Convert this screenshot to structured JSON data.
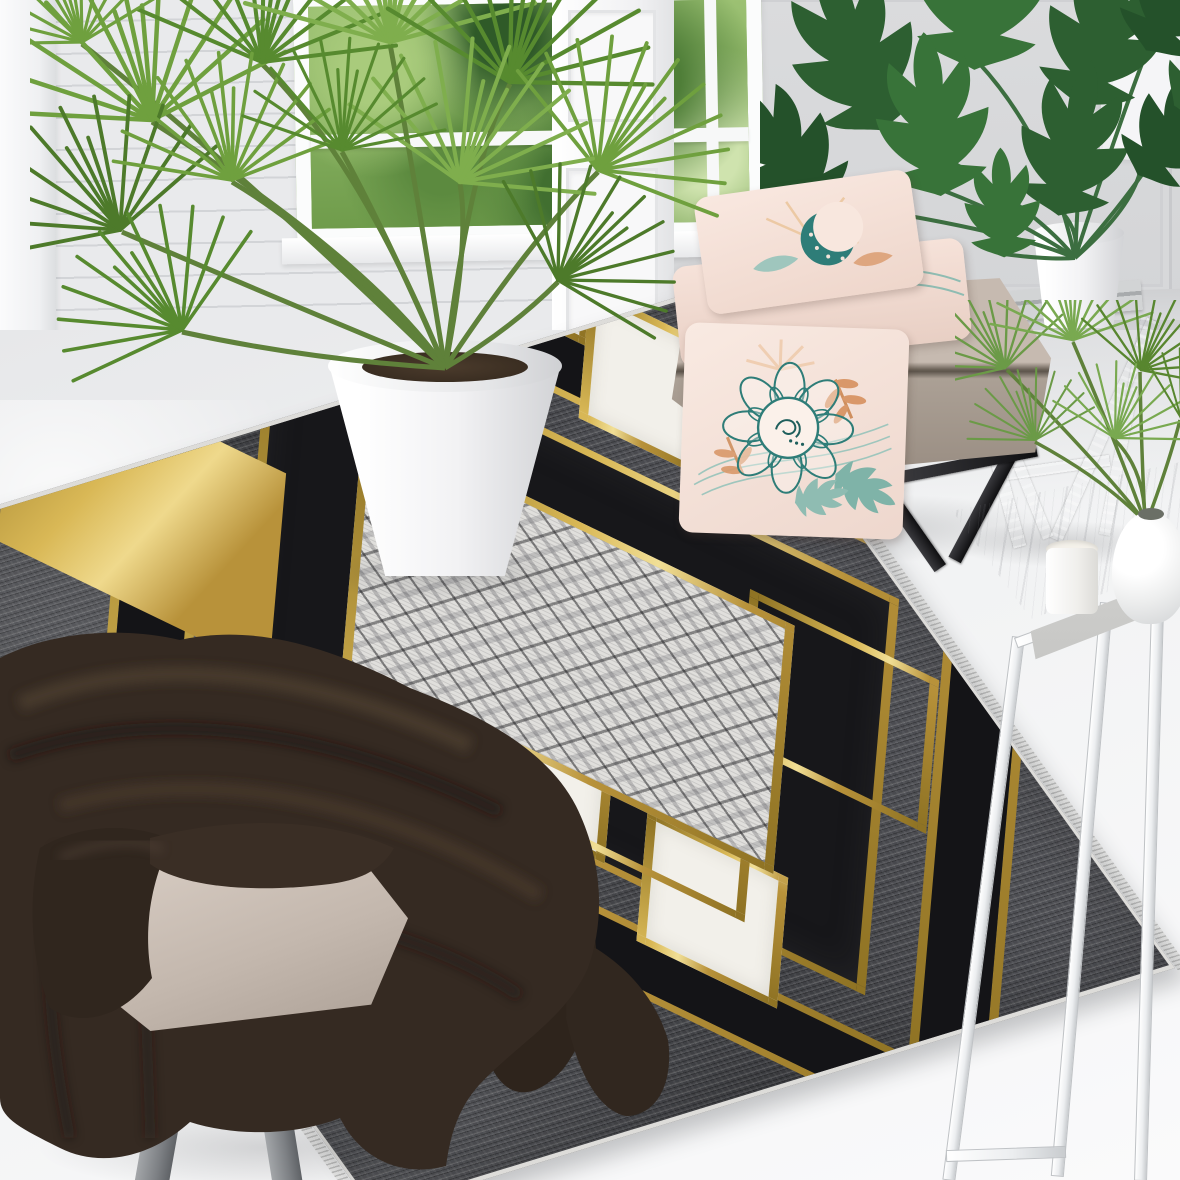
{
  "scene": {
    "type": "interior product photograph",
    "subject": "art-deco geometric area rug styled in a bright living room",
    "no_visible_text": true
  },
  "palette": {
    "wall_shiplap": "#e9eaec",
    "wall_grey": "#d8d9db",
    "pilaster_white": "#f7f7f8",
    "floor": "#eef0f1",
    "window_greens": [
      "#a9cb7c",
      "#4f7e38",
      "#2f5a28",
      "#cfe3ae"
    ],
    "rug_field_grey": "#46474b",
    "rug_black": "#17171a",
    "rug_gold": "#d9b856",
    "rug_gold_dark": "#8f7324",
    "rug_gold_light": "#f1df96",
    "rug_white": "#f2f0ea",
    "fringe_white": "#ededec",
    "pillow_pink": "#f6e2d9",
    "pillow_teal": "#2e7d78",
    "pillow_orange": "#d9986a",
    "ottoman_taupe": "#b4a89d",
    "ottoman_leg": "#232326",
    "blanket_brown": "#352a22",
    "stool_beige": "#cdc1b8",
    "palm_green": "#6fa03e",
    "monstera_green": "#2d5f31",
    "table_marble": "#e8e8e6",
    "table_leg_white": "#eceef0",
    "stand_wood_grey": "#c2c5c6",
    "pot_white": "#fcfcfc"
  },
  "rug": {
    "style": "art-deco",
    "field": "charcoal grey with woven stripe texture",
    "motifs": [
      "central diamond panel with scratched cube-lattice pattern",
      "nested black frames edged in metallic gold",
      "overlapping white rectangles outlined in gold",
      "gold grid patch with black cells at left corner",
      "white bound edges with white fringe on short ends"
    ]
  },
  "objects": [
    "window with garden greenery",
    "shiplap wall",
    "panelled white pilaster and doors",
    "fan palm in white floor pot",
    "monstera in white pot on grey folding stand",
    "taupe ottoman bench with black metal legs",
    "stack of two blush pillows",
    "leaning blush mandala pillow",
    "white marble side table with candle, round vase and areca palm",
    "beige stool draped with dark brown chenille blanket"
  ]
}
